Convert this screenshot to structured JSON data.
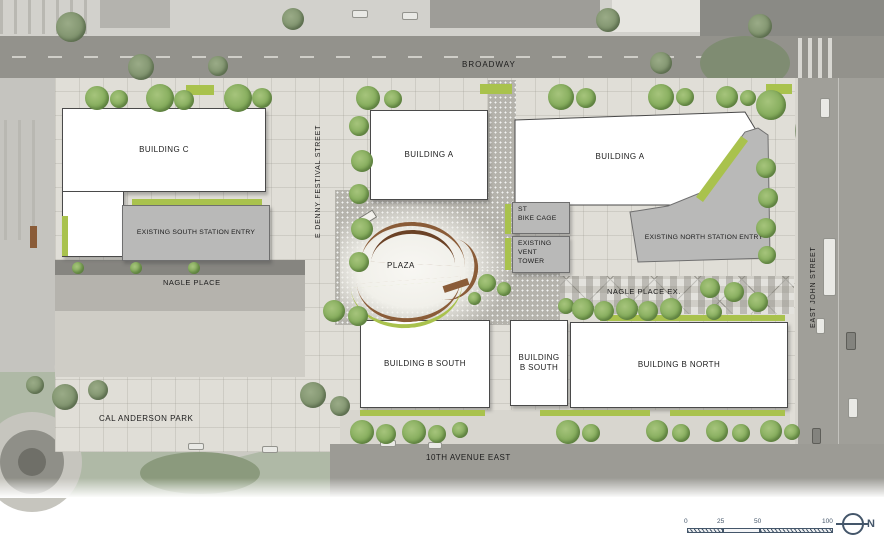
{
  "map": {
    "streets": {
      "broadway": "BROADWAY",
      "e_denny_festival": "E DENNY FESTIVAL STREET",
      "nagle_place": "NAGLE PLACE",
      "nagle_place_ex": "NAGLE PLACE EX.",
      "east_john": "EAST JOHN STREET",
      "tenth_avenue_east": "10TH AVENUE EAST"
    },
    "areas": {
      "plaza": "PLAZA",
      "cal_anderson_park": "CAL ANDERSON PARK"
    },
    "buildings": {
      "building_c": "BUILDING C",
      "building_a_west": "BUILDING A",
      "building_a_east": "BUILDING A",
      "building_b_south": "BUILDING B SOUTH",
      "building_b_south_small": {
        "line1": "BUILDING",
        "line2": "B SOUTH"
      },
      "building_b_north": "BUILDING B NORTH"
    },
    "station_structures": {
      "south_entry": "EXISTING SOUTH STATION ENTRY",
      "north_entry": "EXISTING NORTH STATION ENTRY",
      "bike_cage": {
        "line1": "ST",
        "line2": "BIKE CAGE"
      },
      "vent_tower": {
        "line1": "EXISTING",
        "line2": "VENT",
        "line3": "TOWER"
      }
    }
  },
  "legend": {
    "scale_ticks": [
      "0",
      "25",
      "50",
      "100"
    ],
    "north": "N"
  },
  "colors": {
    "planting_accent": "#a9c24d",
    "tree_green": "#86ad5d",
    "building_white": "#ffffff",
    "structure_gray": "#b9b9b8",
    "legend_blue": "#44566a"
  }
}
